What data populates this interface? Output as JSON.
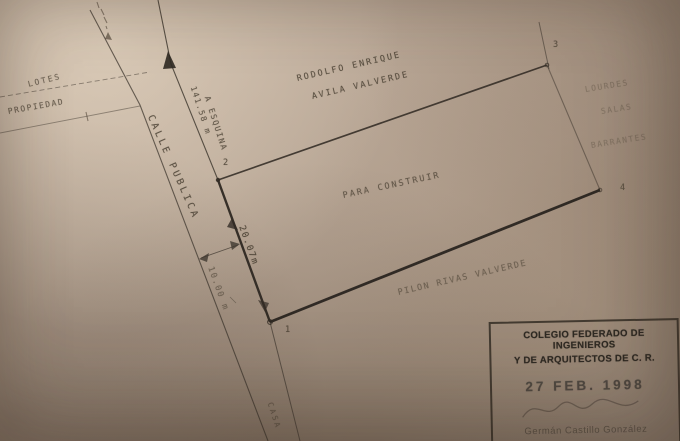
{
  "plan": {
    "street_label": "CALLE PUBLICA",
    "road_destination_fragment": "CASA",
    "owner_line1": "RODOLFO ENRIQUE",
    "owner_line2": "AVILA VALVERDE",
    "center_label": "PARA CONSTRUIR",
    "south_neighbor": "PILON RIVAS VALVERDE",
    "east_neighbor_line1": "LOURDES",
    "east_neighbor_line2": "SALAS",
    "east_neighbor_line3": "BARRANTES",
    "west_label_lotes": "LOTES",
    "west_label_propiedad": "PROPIEDAD",
    "dim_distance_to_corner": "141.58 m",
    "dim_distance_to_corner_ref": "A ESQUINA",
    "dim_frontage": "20.07m",
    "dim_road_width": "10.00 m",
    "corner_1": "1",
    "corner_2": "2",
    "corner_3": "3",
    "corner_4": "4"
  },
  "stamp": {
    "org_line1": "COLEGIO FEDERADO DE INGENIEROS",
    "org_line2": "Y DE ARQUITECTOS DE C. R.",
    "date": "27 FEB. 1998",
    "signed_name": "Germán Castillo González"
  },
  "colors": {
    "paper": "#b5a392",
    "ink": "#3a332b",
    "stamp_ink": "#332e27"
  }
}
